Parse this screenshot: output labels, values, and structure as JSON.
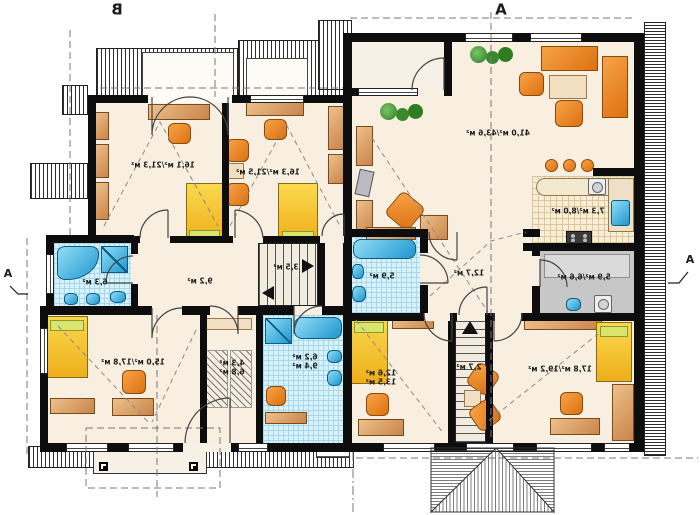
{
  "titles": {
    "left_section": "B",
    "right_section": "A"
  },
  "section_markers": {
    "left": "А",
    "right": "А"
  },
  "rooms": {
    "b_room1": {
      "area": "16,1 м²/21,3 м²"
    },
    "b_room2": {
      "area": "16,3 м²/21,5 м²"
    },
    "b_bath_upper": {
      "area": "6,3 м²"
    },
    "b_hall": {
      "area": "9,2 м²"
    },
    "b_stairs": {
      "area": "3,5 м²"
    },
    "b_bedroom": {
      "area": "15,0 м²/17,8 м²"
    },
    "b_wardrobe": {
      "area_line1": "4,3 м²",
      "area_line2": "6,8 м²"
    },
    "b_bath_lower": {
      "area_line1": "6,2 м²",
      "area_line2": "9,4 м²"
    },
    "a_living": {
      "area": "41,0 м²/43,6 м²"
    },
    "a_kitchen": {
      "area": "7,3 м²/8,0 м²"
    },
    "a_bath": {
      "area": "5,9 м²"
    },
    "a_hall": {
      "area": "12,7 м²"
    },
    "a_utility": {
      "area": "5,9 м²/6,6 м²"
    },
    "a_bedroom_left": {
      "area_line1": "12,6 м²",
      "area_line2": "13,5 м²"
    },
    "a_stairs": {
      "area": "2,7 м²"
    },
    "a_bedroom_right": {
      "area": "17,8 м²/19,2 м²"
    }
  },
  "colors": {
    "floor": "#f8efe0",
    "wall": "#0d0d0d",
    "tile": "#d9f1fa",
    "fixture_blue": "#1f96cf",
    "wood": "#c9854a",
    "furniture_orange": "#dd7110",
    "bed_yellow": "#eeae1a",
    "pillow_green": "#d9e56c",
    "plant_green": "#2e7d22",
    "utility_gray": "#c7c7c7",
    "kitchen_counter": "#f8eed6"
  }
}
